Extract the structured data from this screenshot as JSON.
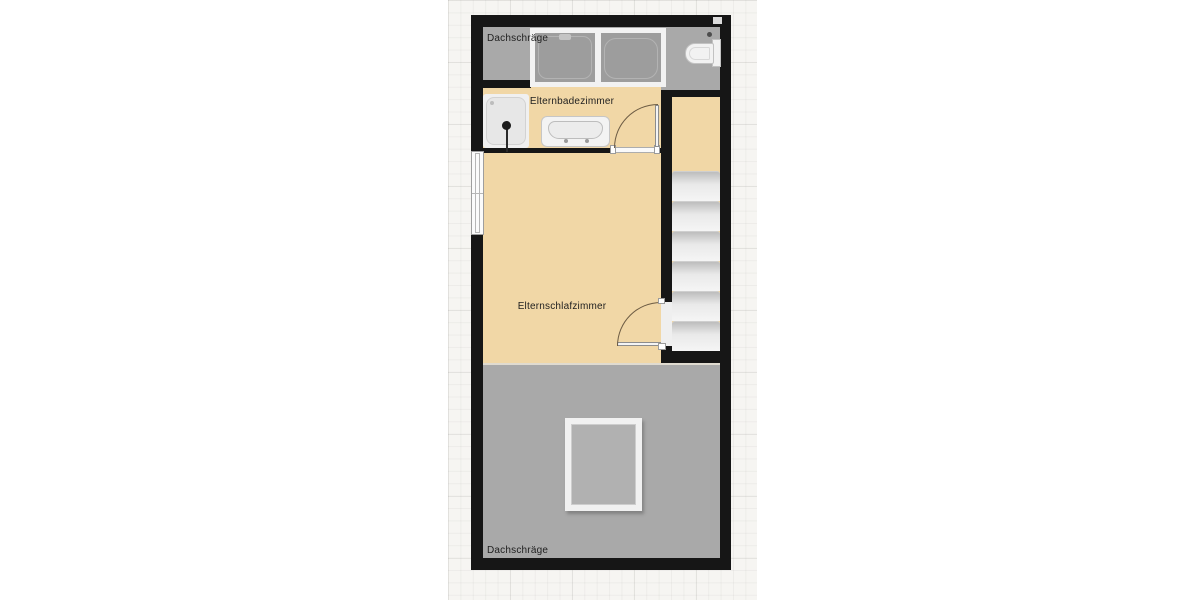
{
  "canvas": {
    "type": "floor-plan",
    "grid": true
  },
  "labels": {
    "zone_top": "Dachschräge",
    "bathroom": "Elternbadezimmer",
    "bedroom": "Elternschlafzimmer",
    "zone_bottom": "Dachschräge"
  },
  "rooms": [
    {
      "label": "Elternbadezimmer",
      "type": "bathroom",
      "floor_color": "#f1d7a6"
    },
    {
      "label": "Elternschlafzimmer",
      "type": "bedroom",
      "floor_color": "#f1d7a6"
    }
  ],
  "zones": [
    {
      "label": "Dachschräge",
      "position": "top",
      "color": "#a9a9a9"
    },
    {
      "label": "Dachschräge",
      "position": "bottom",
      "color": "#a9a9a9"
    }
  ],
  "fixtures": [
    {
      "name": "bathtub",
      "location": "top zone"
    },
    {
      "name": "toilet",
      "location": "top zone"
    },
    {
      "name": "shower",
      "location": "bathroom"
    },
    {
      "name": "sink",
      "location": "bathroom"
    },
    {
      "name": "stairs",
      "location": "stairwell",
      "treads": 6
    },
    {
      "name": "window",
      "location": "bedroom left wall"
    },
    {
      "name": "door",
      "location": "bathroom"
    },
    {
      "name": "door",
      "location": "bedroom to stairs"
    },
    {
      "name": "roof-window",
      "location": "bottom zone"
    }
  ],
  "colors": {
    "wall": "#161616",
    "floor": "#f1d7a6",
    "sloped_zone": "#a9a9a9",
    "stair_tread": "#f2f2f2",
    "fixture_white": "#f2f2f2",
    "door_arc": "#6c5b43",
    "canvas_bg": "#f6f5f2",
    "page_bg": "#ffffff",
    "text": "#1f1f1f"
  }
}
